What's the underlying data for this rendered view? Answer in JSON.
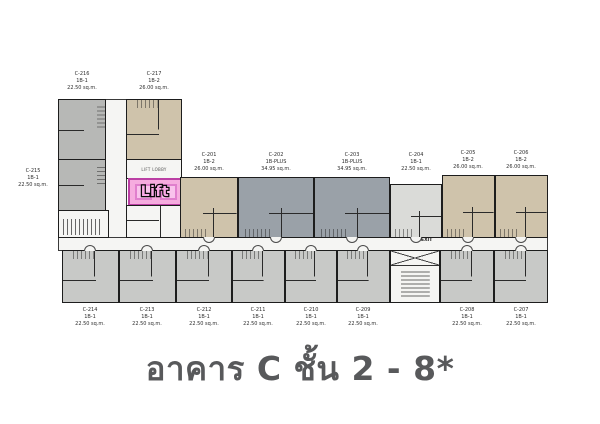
{
  "title": "อาคาร C ชั้น 2 - 8*",
  "labels": {
    "lift": "Lift",
    "lift_lobby": "LIFT LOBBY",
    "exit": "EXIT"
  },
  "colors": {
    "unit_gray": "#b7b8b6",
    "unit_gray_light": "#c8c9c7",
    "unit_beige": "#cfc3ab",
    "unit_bluegray": "#9aa1a8",
    "unit_lightgray": "#dadbd8",
    "lift_pink": "#f6acdf",
    "lift_border": "#bb3fa4",
    "title_color": "#58595b"
  },
  "units": {
    "wing": [
      {
        "id": "C-216",
        "type": "1B-1",
        "area": "22.50 sq.m."
      },
      {
        "id": "C-217",
        "type": "1B-2",
        "area": "26.00 sq.m."
      },
      {
        "id": "C-215",
        "type": "1B-1",
        "area": "22.50 sq.m."
      }
    ],
    "top": [
      {
        "id": "C-201",
        "type": "1B-2",
        "area": "26.00 sq.m."
      },
      {
        "id": "C-202",
        "type": "1B-PLUS",
        "area": "34.95 sq.m."
      },
      {
        "id": "C-203",
        "type": "1B-PLUS",
        "area": "34.95 sq.m."
      },
      {
        "id": "C-204",
        "type": "1B-1",
        "area": "22.50 sq.m."
      },
      {
        "id": "C-205",
        "type": "1B-2",
        "area": "26.00 sq.m."
      },
      {
        "id": "C-206",
        "type": "1B-2",
        "area": "26.00 sq.m."
      }
    ],
    "bottom": [
      {
        "id": "C-214",
        "type": "1B-1",
        "area": "22.50 sq.m."
      },
      {
        "id": "C-213",
        "type": "1B-1",
        "area": "22.50 sq.m."
      },
      {
        "id": "C-212",
        "type": "1B-1",
        "area": "22.50 sq.m."
      },
      {
        "id": "C-211",
        "type": "1B-1",
        "area": "22.50 sq.m."
      },
      {
        "id": "C-210",
        "type": "1B-1",
        "area": "22.50 sq.m."
      },
      {
        "id": "C-209",
        "type": "1B-1",
        "area": "22.50 sq.m."
      },
      {
        "id": "C-208",
        "type": "1B-1",
        "area": "22.50 sq.m."
      },
      {
        "id": "C-207",
        "type": "1B-1",
        "area": "22.50 sq.m."
      }
    ]
  }
}
